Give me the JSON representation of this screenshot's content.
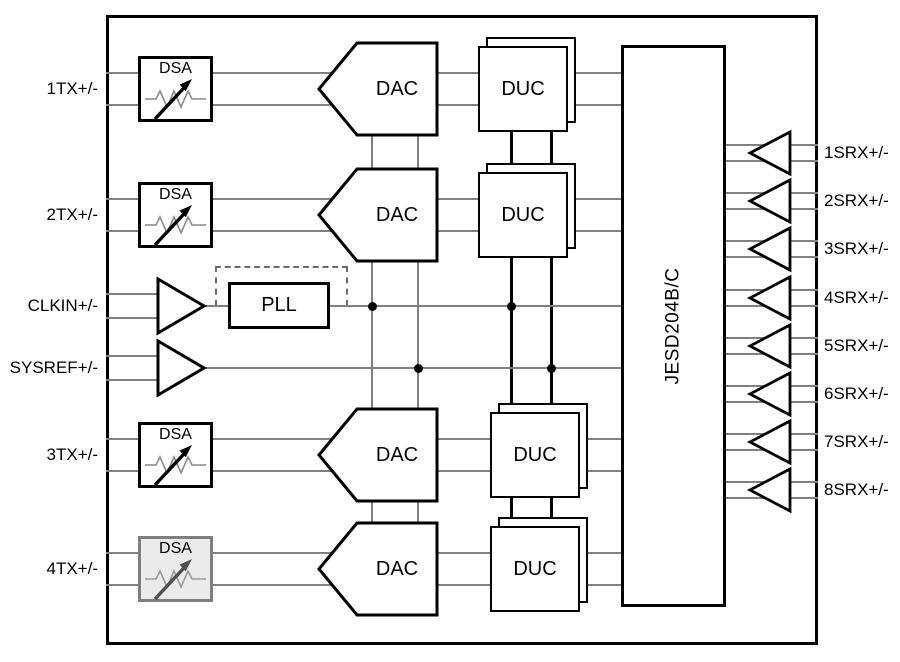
{
  "diagram": {
    "blocks": {
      "dsa_label": "DSA",
      "dac_label": "DAC",
      "duc_label": "DUC",
      "pll_label": "PLL",
      "jesd_label": "JESD204B/C"
    },
    "tx_channels": [
      {
        "port": "1TX+/-",
        "cy": 89,
        "duc_x": 478,
        "dsa_disabled": false
      },
      {
        "port": "2TX+/-",
        "cy": 215,
        "duc_x": 478,
        "dsa_disabled": false
      },
      {
        "port": "3TX+/-",
        "cy": 455,
        "duc_x": 490,
        "dsa_disabled": false
      },
      {
        "port": "4TX+/-",
        "cy": 569,
        "duc_x": 490,
        "dsa_disabled": true
      }
    ],
    "clock": {
      "port": "CLKIN+/-",
      "cy": 306
    },
    "sysref": {
      "port": "SYSREF+/-",
      "cy": 368
    },
    "serdes_lanes": [
      {
        "port": "1SRX+/-",
        "cy": 153
      },
      {
        "port": "2SRX+/-",
        "cy": 201
      },
      {
        "port": "3SRX+/-",
        "cy": 249
      },
      {
        "port": "4SRX+/-",
        "cy": 298
      },
      {
        "port": "5SRX+/-",
        "cy": 346
      },
      {
        "port": "6SRX+/-",
        "cy": 394
      },
      {
        "port": "7SRX+/-",
        "cy": 442
      },
      {
        "port": "8SRX+/-",
        "cy": 490
      }
    ],
    "junctions": [
      {
        "x": 372,
        "y": 306
      },
      {
        "x": 511,
        "y": 306
      },
      {
        "x": 418,
        "y": 368
      },
      {
        "x": 551,
        "y": 368
      }
    ],
    "colors": {
      "wire": "#808080",
      "outline": "#000000",
      "background": "#ffffff",
      "disabled_fill": "#ebebeb",
      "disabled_stroke": "#7f7f7f"
    }
  }
}
